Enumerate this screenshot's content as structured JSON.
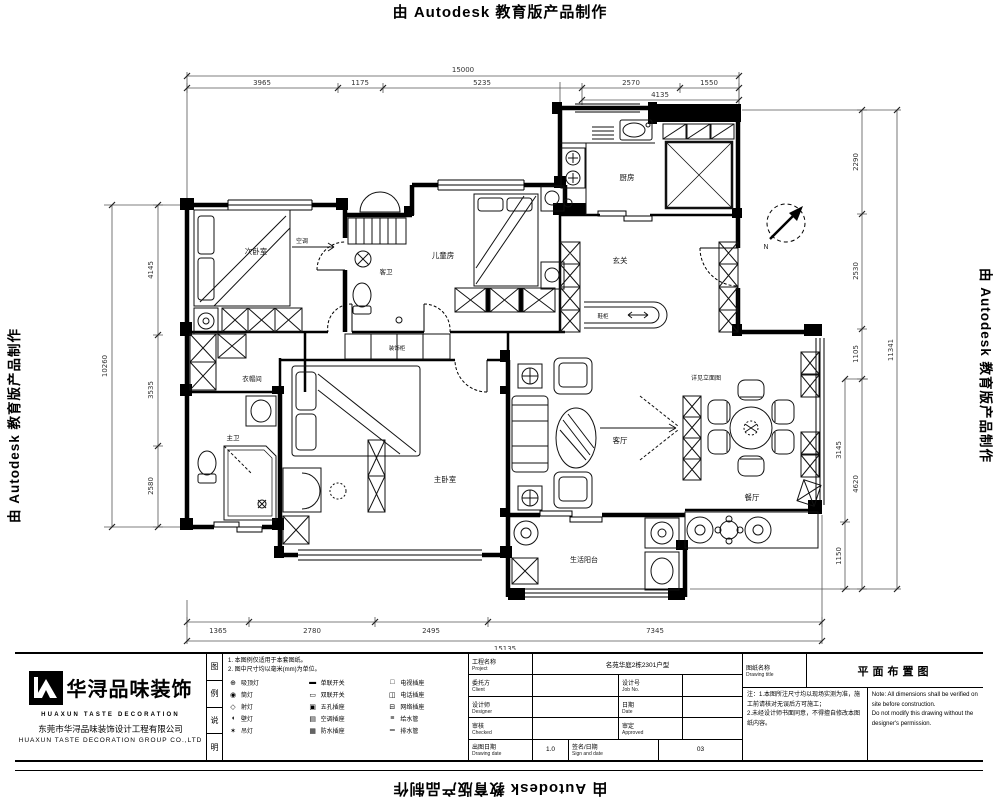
{
  "watermarks": {
    "text": "由 Autodesk 教育版产品制作"
  },
  "plan": {
    "north_label": "N",
    "rooms": {
      "kitchen": "厨房",
      "kids_room": "儿童房",
      "guest_bath": "客卫",
      "bedroom2": "次卧室",
      "cloakroom": "衣帽间",
      "master_bath": "主卫",
      "master_bedroom": "主卧室",
      "living_room": "客厅",
      "dining_room": "餐厅",
      "foyer": "玄关",
      "balcony": "生活阳台",
      "cabinet": "装饰柜",
      "shoe_cabinet": "鞋柜"
    },
    "annotations": {
      "tv_note": "详见立面图",
      "ac_note": "空调"
    },
    "dims": {
      "top": {
        "overall": "15000",
        "segs": [
          "3965",
          "1175",
          "5235",
          "2570",
          "1550"
        ],
        "sub": "4135"
      },
      "bottom": {
        "overall": "15135",
        "segs": [
          "1365",
          "2780",
          "2495",
          "7345"
        ]
      },
      "left": {
        "overall": "10260",
        "segs": [
          "4145",
          "3535",
          "2580"
        ]
      },
      "right": {
        "overall": "11341",
        "segs": [
          "2290",
          "2530",
          "1105",
          "4620"
        ],
        "sub": [
          "3145",
          "1150"
        ]
      }
    }
  },
  "title_block": {
    "logo": {
      "cn": "华浔品味装饰",
      "en": "HUAXUN TASTE DECORATION",
      "company_cn": "东莞市华浔品味装饰设计工程有限公司",
      "company_en": "HUAXUN TASTE DECORATION GROUP CO.,LTD"
    },
    "side_chars": [
      "图",
      "例",
      "说",
      "明"
    ],
    "legend": {
      "notes": [
        "1. 本图例仅适用于本套图纸。",
        "2. 图中尺寸均以毫米(mm)为单位。"
      ],
      "items": [
        {
          "sym": "ceiling-lamp-icon",
          "glyph": "⊕",
          "label": "吸顶灯"
        },
        {
          "sym": "downlight-icon",
          "glyph": "◉",
          "label": "筒灯"
        },
        {
          "sym": "spotlight-icon",
          "glyph": "◇",
          "label": "射灯"
        },
        {
          "sym": "wall-lamp-icon",
          "glyph": "◖",
          "label": "壁灯"
        },
        {
          "sym": "pendant-lamp-icon",
          "glyph": "✶",
          "label": "吊灯"
        },
        {
          "sym": "switch-single-icon",
          "glyph": "▬",
          "label": "单联开关"
        },
        {
          "sym": "switch-double-icon",
          "glyph": "▭",
          "label": "双联开关"
        },
        {
          "sym": "socket-5hole-icon",
          "glyph": "▣",
          "label": "五孔插座"
        },
        {
          "sym": "socket-ac-icon",
          "glyph": "▤",
          "label": "空调插座"
        },
        {
          "sym": "socket-wp-icon",
          "glyph": "▦",
          "label": "防水插座"
        },
        {
          "sym": "socket-tv-icon",
          "glyph": "□",
          "label": "电视插座"
        },
        {
          "sym": "socket-tel-icon",
          "glyph": "◫",
          "label": "电话插座"
        },
        {
          "sym": "socket-net-icon",
          "glyph": "⊟",
          "label": "网络插座"
        },
        {
          "sym": "water-supply-icon",
          "glyph": "≡",
          "label": "给水管"
        },
        {
          "sym": "water-drain-icon",
          "glyph": "═",
          "label": "排水管"
        }
      ]
    },
    "fields": {
      "project_label": "工程名称",
      "project_label_en": "Project",
      "project_value": "名苑华庭2栋2301户型",
      "client_label": "委托方",
      "client_label_en": "Client",
      "client_value": "",
      "jobno_label": "设计号",
      "jobno_label_en": "Job No.",
      "jobno_value": "",
      "designer_label": "设计师",
      "designer_label_en": "Designer",
      "designer_value": "",
      "date_label": "日期",
      "date_label_en": "Date",
      "date_value": "",
      "checked_label": "审核",
      "checked_label_en": "Checked",
      "approved_label": "审定",
      "approved_label_en": "Approved",
      "drawdate_label": "出图日期",
      "drawdate_label_en": "Drawing date",
      "version": "1.0",
      "sign_label": "签名/日期",
      "sign_label_en": "Sign and date",
      "sheet_no": "03",
      "title_label": "图纸名称",
      "title_label_en": "Drawing title",
      "title_value": "平面布置图",
      "notes_cn_1": "注：1.本图所注尺寸均以现场实测为准，施工前请核对无误后方可施工；",
      "notes_cn_2": "2.未经设计师书面同意，不得擅自修改本图纸内容。",
      "notes_en_1": "Note: All dimensions shall be verified on site before construction.",
      "notes_en_2": "Do not modify this drawing without the designer's permission."
    }
  }
}
